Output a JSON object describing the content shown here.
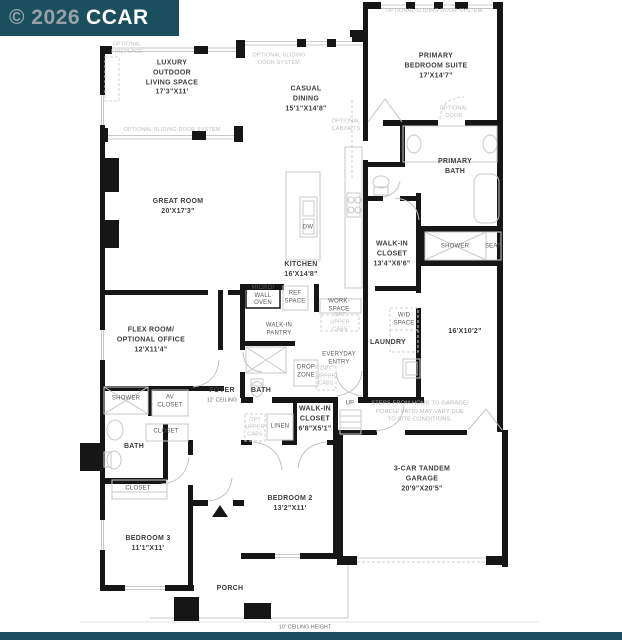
{
  "watermark": {
    "prefix": "© 2026",
    "brand": "CCAR"
  },
  "colors": {
    "brand_bar": "#1B4F5E",
    "wall": "#161616",
    "optional_text": "#BDBDBD",
    "label_text": "#3E3E3E"
  },
  "labels": {
    "luxury_outdoor": "LUXURY\nOUTDOOR\nLIVING SPACE\n17'3\"X11'",
    "casual_dining": "CASUAL\nDINING\n15'1\"X14'8\"",
    "primary_bedroom": "PRIMARY\nBEDROOM SUITE\n17'X14'7\"",
    "great_room": "GREAT ROOM\n20'X17'3\"",
    "primary_bath": "PRIMARY\nBATH",
    "walk_in_closet_primary": "WALK-IN\nCLOSET\n13'4\"X6'6\"",
    "kitchen": "KITCHEN\n16'X14'8\"",
    "flex_room": "FLEX ROOM/\nOPTIONAL OFFICE\n12'X11'4\"",
    "bonus_space": "16'X10'2\"",
    "laundry": "LAUNDRY",
    "foyer": "FOYER",
    "foyer_ceiling": "12' CEILING",
    "bath_center": "BATH",
    "walk_in_closet_2": "WALK-IN\nCLOSET\n6'8\"X5'1\"",
    "bedroom_2": "BEDROOM 2\n13'2\"X11'",
    "bath_left": "BATH",
    "bedroom_3": "BEDROOM 3\n11'1\"X11'",
    "garage": "3-CAR TANDEM\nGARAGE\n20'9\"X20'5\"",
    "porch": "PORCH",
    "shower": "SHOWER",
    "seat": "SEAT",
    "dw": "DW",
    "micro_wall_oven": "MICRO/\nWALL\nOVEN",
    "ref_space": "REF\nSPACE",
    "work_space": "WORK-\nSPACE",
    "walk_in_pantry": "WALK-IN\nPANTRY",
    "wd_space": "W/D\nSPACE",
    "everyday_entry": "EVERYDAY\nENTRY",
    "drop_zone": "DROP\nZONE",
    "up": "UP",
    "linen": "LINEN",
    "av_closet": "AV\nCLOSET",
    "closet": "CLOSET",
    "optional_fireplace": "OPTIONAL\nFIREPLACE",
    "optional_sliding_door_two_line": "OPTIONAL SLIDING\nDOOR SYSTEM",
    "optional_sliding_door": "OPTIONAL SLIDING DOOR SYSTEM",
    "optional_cabinets": "OPTIONAL\nCABINETS",
    "optional_door": "OPTIONAL\nDOOR",
    "opt_upper_cabs": "OPT\nUPPER\nCABS",
    "steps_note": "STEPS FROM HOME TO GARAGE/\nPORCH/ PATIO MAY VARY DUE\nTO SITE CONDITIONS.",
    "ceiling_height": "10' CEILING HEIGHT"
  }
}
